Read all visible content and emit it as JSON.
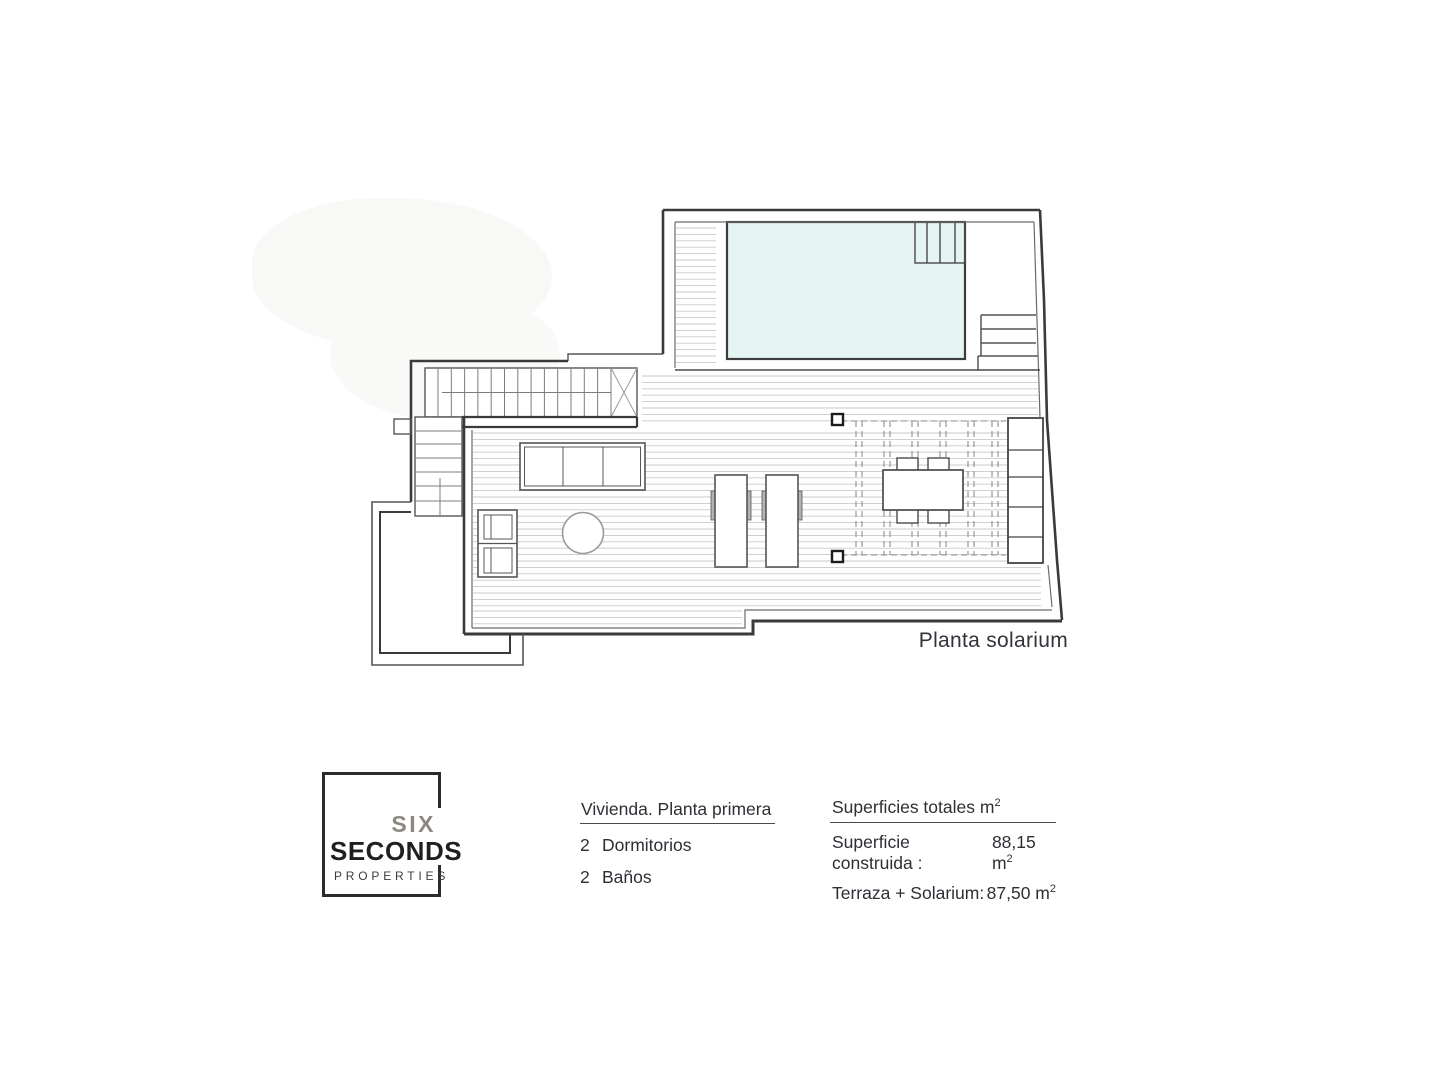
{
  "plan": {
    "caption": "Planta solarium",
    "pool_fill": "#e4f4f3",
    "wall_color": "#3a3a3a",
    "deck_line_color": "#c9c9c9"
  },
  "footer": {
    "logo": {
      "word1": "SIX",
      "word2": "SECONDS",
      "word3": "PROPERTIES",
      "gray": "#8d8880",
      "black": "#1f1f1f"
    },
    "dwelling": {
      "heading": "Vivienda. Planta primera",
      "items": [
        {
          "qty": "2",
          "label": "Dormitorios"
        },
        {
          "qty": "2",
          "label": "Baños"
        }
      ]
    },
    "areas": {
      "heading": "Superficies totales m",
      "heading_sup": "2",
      "rows": [
        {
          "label": "Superficie construida :",
          "value": "88,15 m",
          "sup": "2"
        },
        {
          "label": "Terraza + Solarium:",
          "value": "87,50 m",
          "sup": "2"
        }
      ]
    }
  }
}
